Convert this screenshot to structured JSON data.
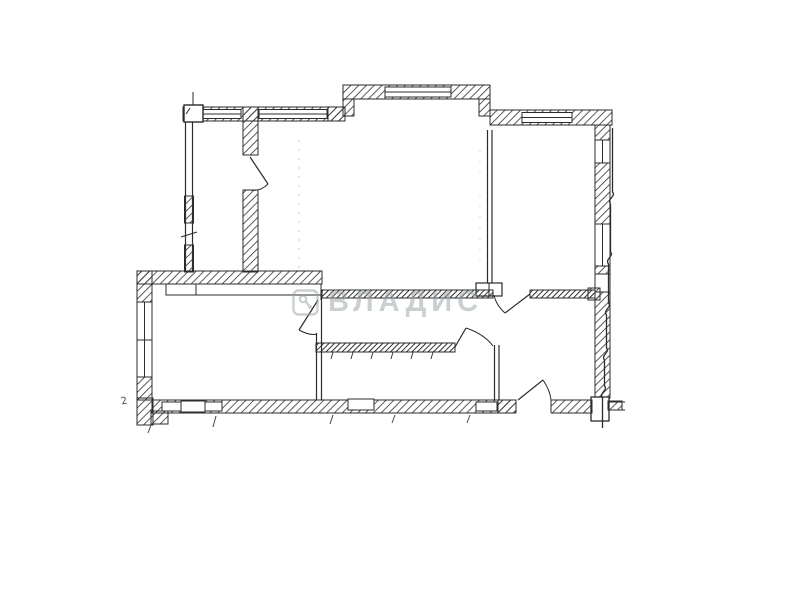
{
  "watermark": {
    "text": "ВЛАДИС",
    "logo_icon": "vladis-badge-icon",
    "color": "#9aa4a8",
    "opacity": 0.52
  },
  "annotations": {
    "stray_mark": "2"
  },
  "palette": {
    "background": "#ffffff",
    "line": "#2b2b2b",
    "hatch": "#3d3d3d",
    "scan_artifact": "#c5c5c5",
    "watermark_gray": "#9aa4a8"
  }
}
